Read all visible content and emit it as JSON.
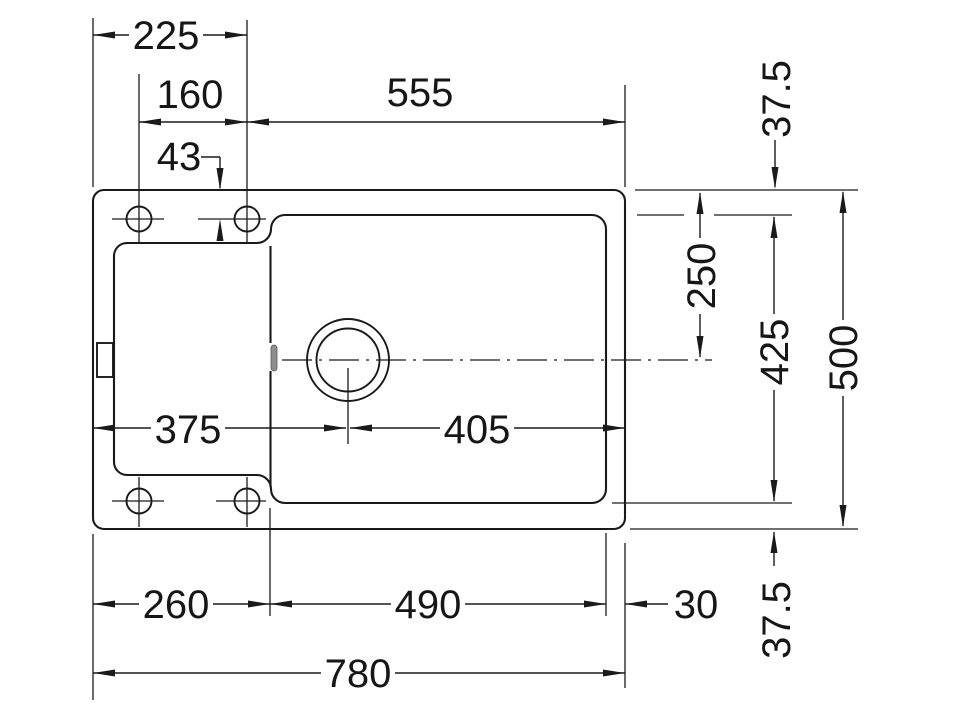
{
  "colors": {
    "line": "#1a1a1a",
    "background": "#ffffff",
    "overflow_slot": "#8d8d8d"
  },
  "dims": {
    "left_edge_to_right_hole": "225",
    "hole_spacing": "160",
    "right_hole_to_right_edge": "555",
    "top_edge_to_hole_center": "43",
    "left_edge_to_drain_center": "375",
    "drain_center_to_right_edge": "405",
    "left_edge_to_bowl": "260",
    "bowl_width": "490",
    "bowl_to_right_edge": "30",
    "overall_width": "780",
    "top_rim": "37.5",
    "top_edge_to_drain_axis": "250",
    "bowl_front_to_back": "425",
    "overall_depth": "500",
    "bottom_rim": "37.5"
  }
}
